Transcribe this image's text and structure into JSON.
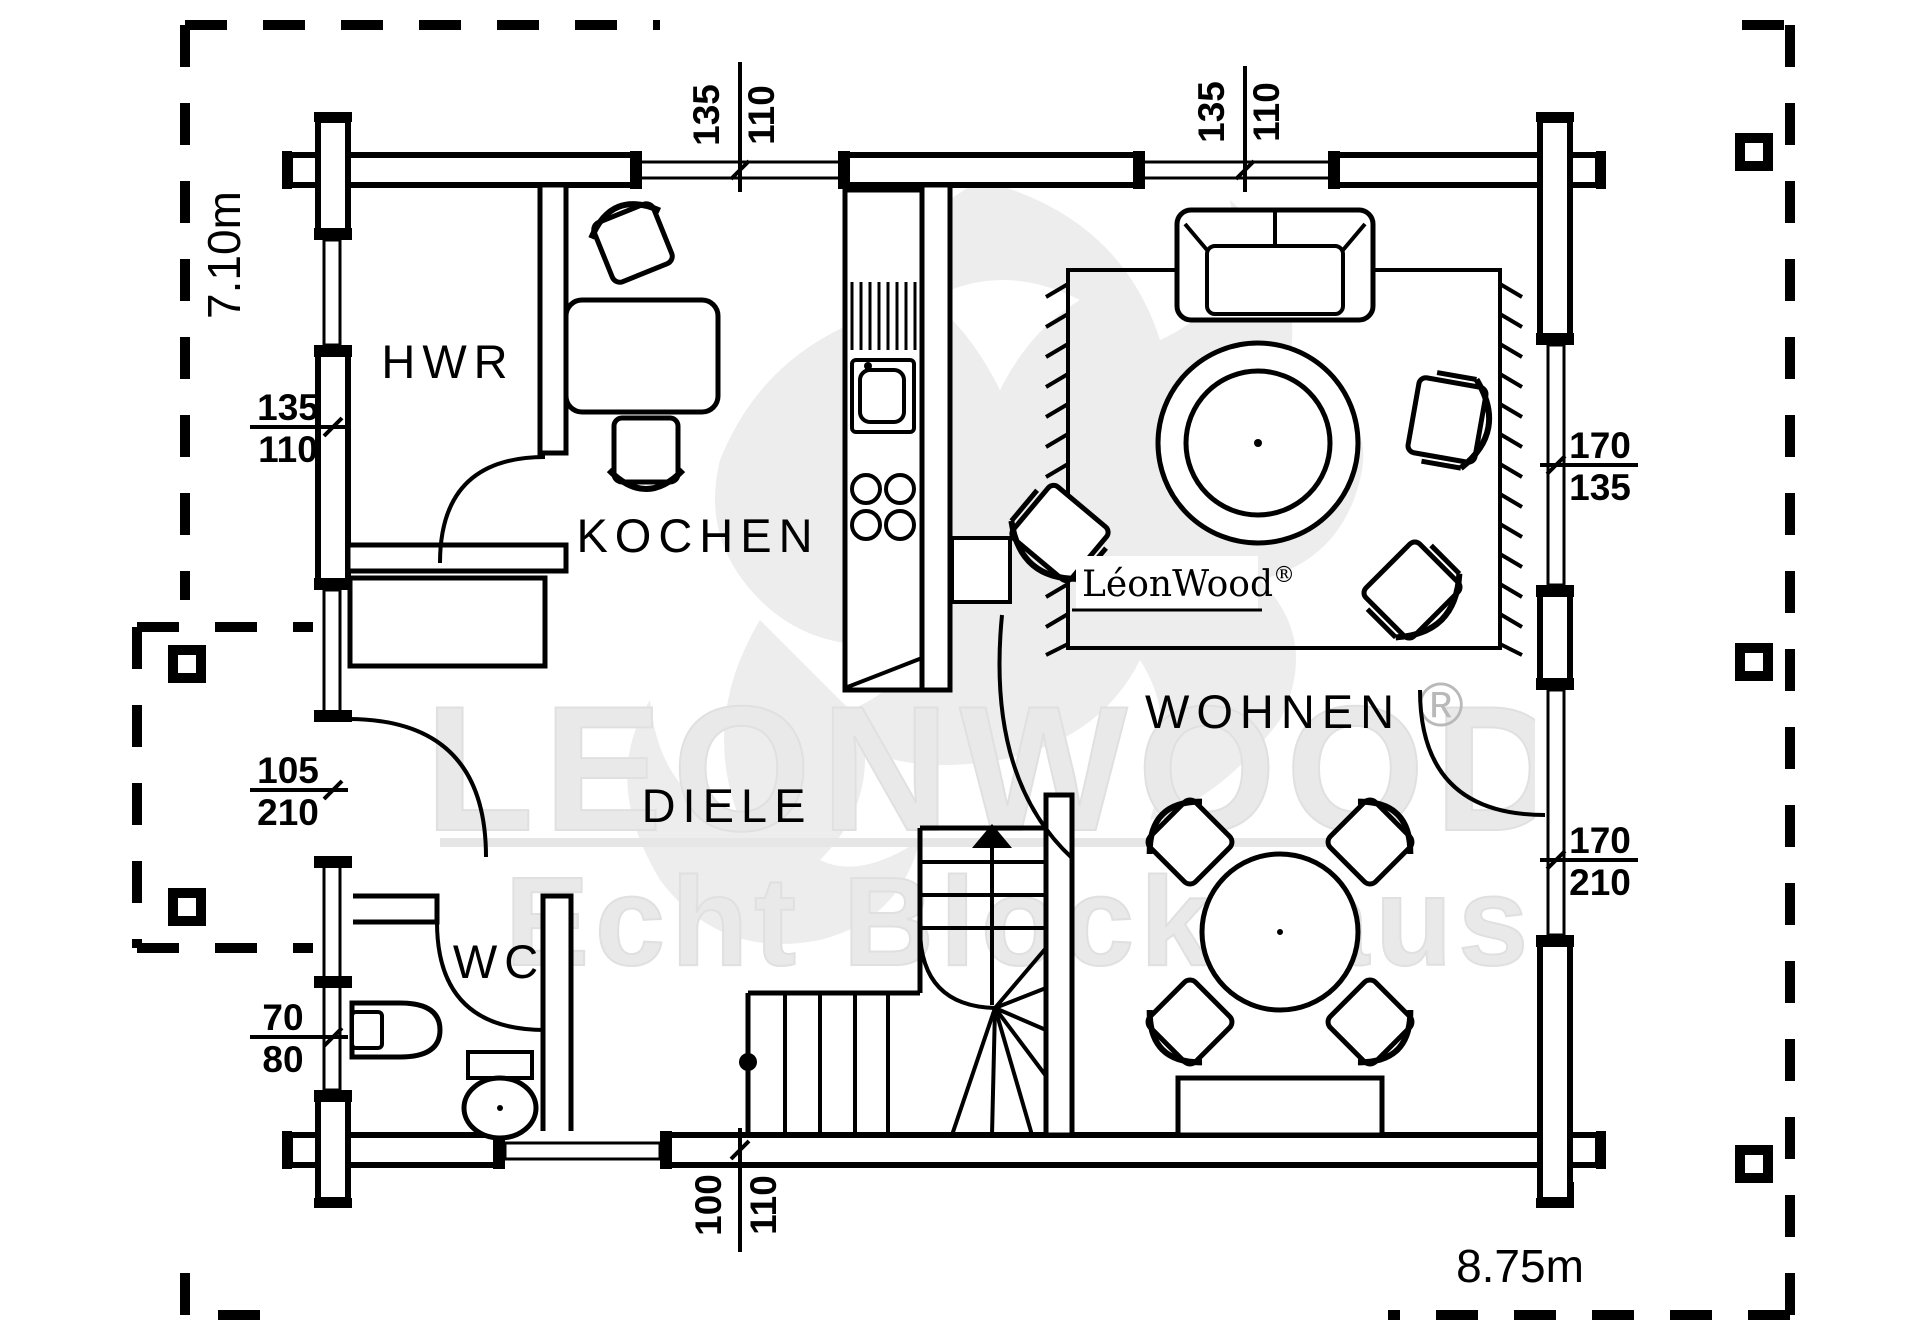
{
  "plan": {
    "rooms": {
      "hwr": "HWR",
      "kochen": "KOCHEN",
      "diele": "DIELE",
      "wc": "WC",
      "wohnen": "WOHNEN"
    },
    "overall_width": "8.75m",
    "overall_depth": "7.10m",
    "dims": {
      "top_window_1": {
        "w": "135",
        "h": "110"
      },
      "top_window_2": {
        "w": "135",
        "h": "110"
      },
      "left_window": {
        "w": "135",
        "h": "110"
      },
      "entrance_door": {
        "w": "105",
        "h": "210"
      },
      "wc_window": {
        "w": "70",
        "h": "80"
      },
      "right_window": {
        "w": "170",
        "h": "135"
      },
      "terrace_door": {
        "w": "170",
        "h": "210"
      },
      "bottom_window": {
        "w": "100",
        "h": "110"
      }
    },
    "brand": {
      "logo_text": "LéonWood",
      "registered": "®",
      "watermark_line1": "LEONWOOD",
      "watermark_line2": "Echt Blockhaus"
    }
  },
  "colors": {
    "ink": "#000000",
    "paper": "#ffffff",
    "watermark": "#e9e9e9"
  }
}
